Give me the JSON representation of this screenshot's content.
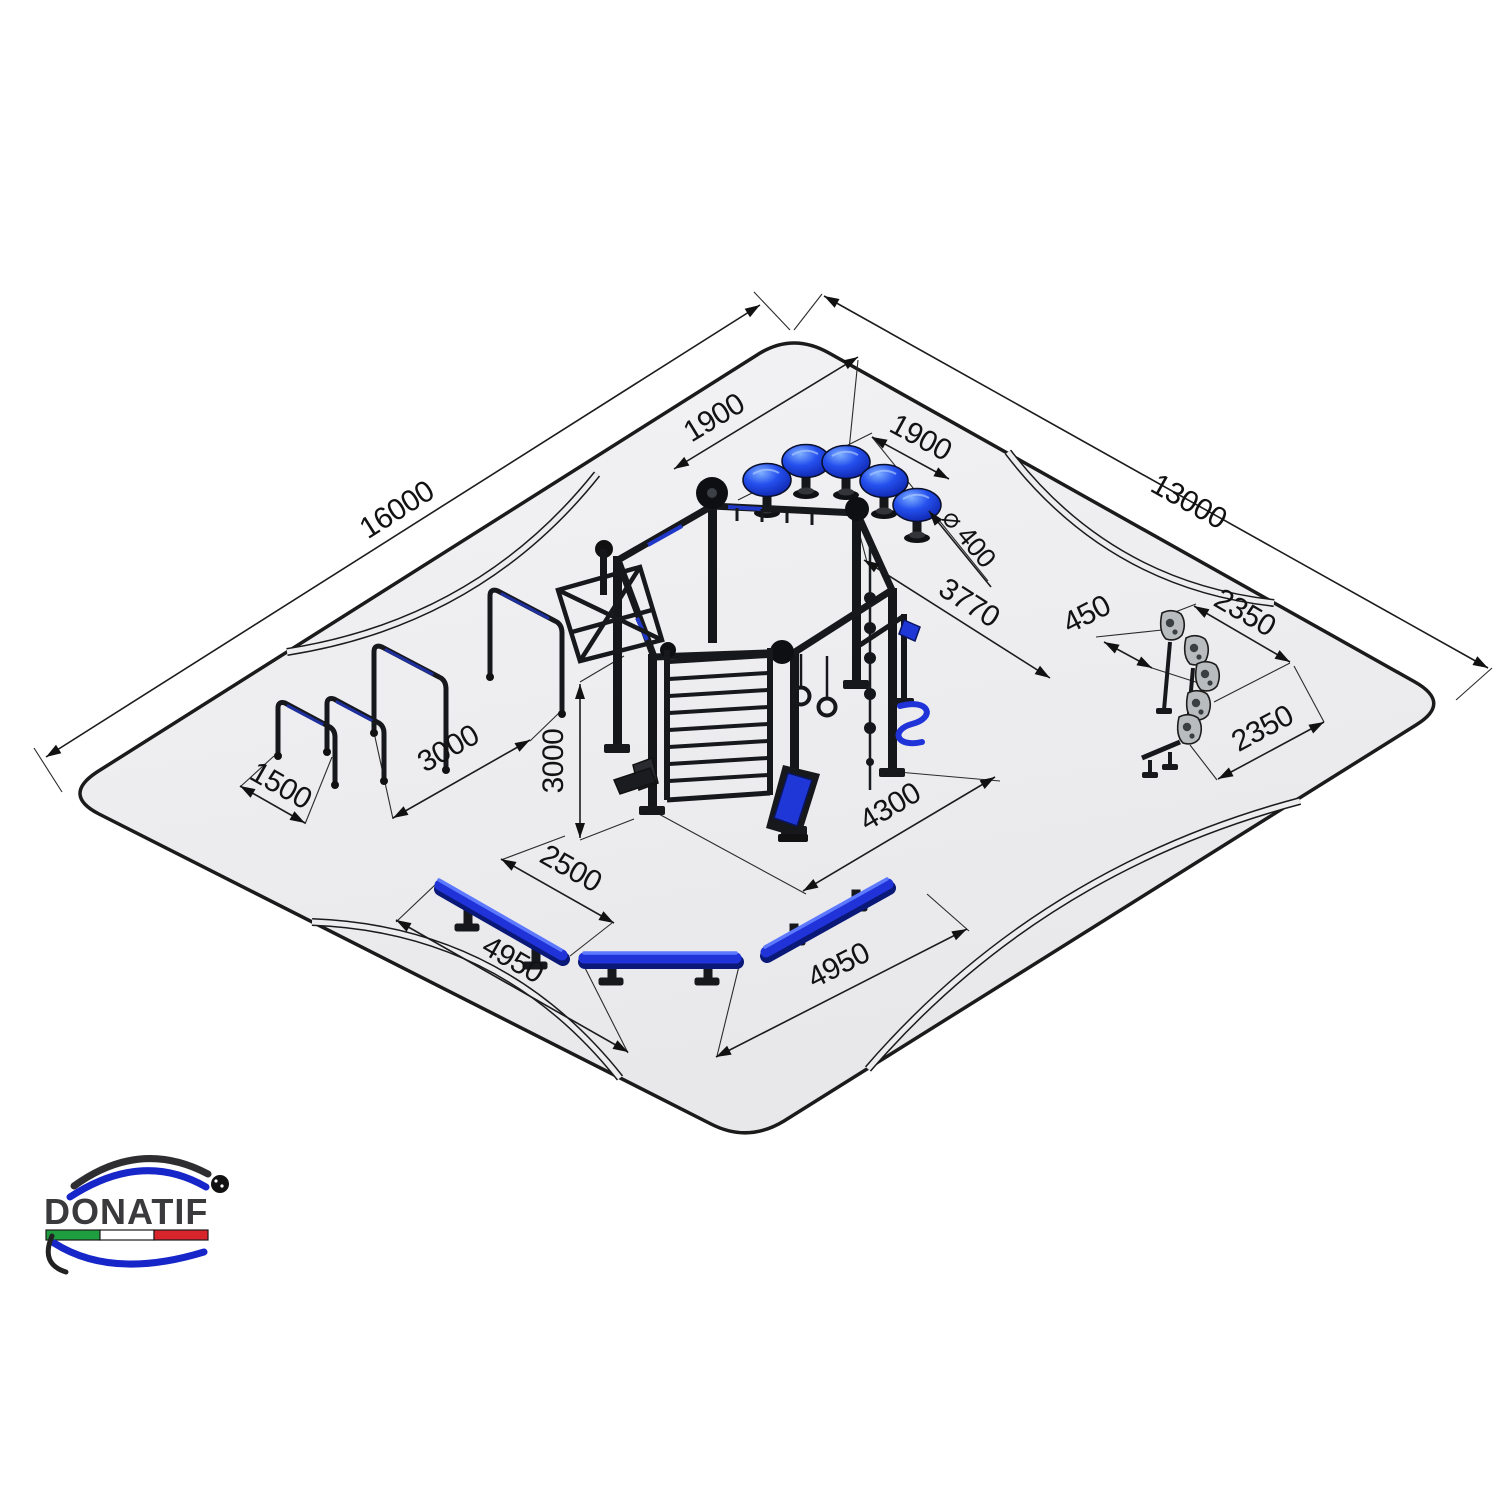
{
  "drawing": {
    "type": "isometric-site-plan",
    "description_semantic": "outdoor calisthenics park layout plan"
  },
  "annotations": {
    "platform_length": "16000",
    "platform_width": "13000",
    "mushroom_pitch_left": "1900",
    "mushroom_pitch_right": "1900",
    "mushroom_diameter": "⌀ 400",
    "rig_depth": "3770",
    "rig_width": "4300",
    "rig_height": "3000",
    "hurdle_gap": "1500",
    "hurdle_span": "3000",
    "bench_offset": "2500",
    "bench_span_left": "4950",
    "bench_span_right": "4950",
    "stones_width": "450",
    "stones_span_upper": "2350",
    "stones_span_lower": "2350"
  },
  "brand": {
    "name": "DONATIF",
    "registered": "®"
  },
  "colors": {
    "platform_gray": "#ededef",
    "line_black": "#1b1b1b",
    "steel_black": "#17181c",
    "accent_blue": "#2033d8",
    "stone_gray": "#b8bcbe",
    "logo_blue": "#1726c9",
    "logo_dark": "#2e2e30",
    "flag_green": "#1e9e3e",
    "flag_white": "#ffffff",
    "flag_red": "#d8252c"
  }
}
